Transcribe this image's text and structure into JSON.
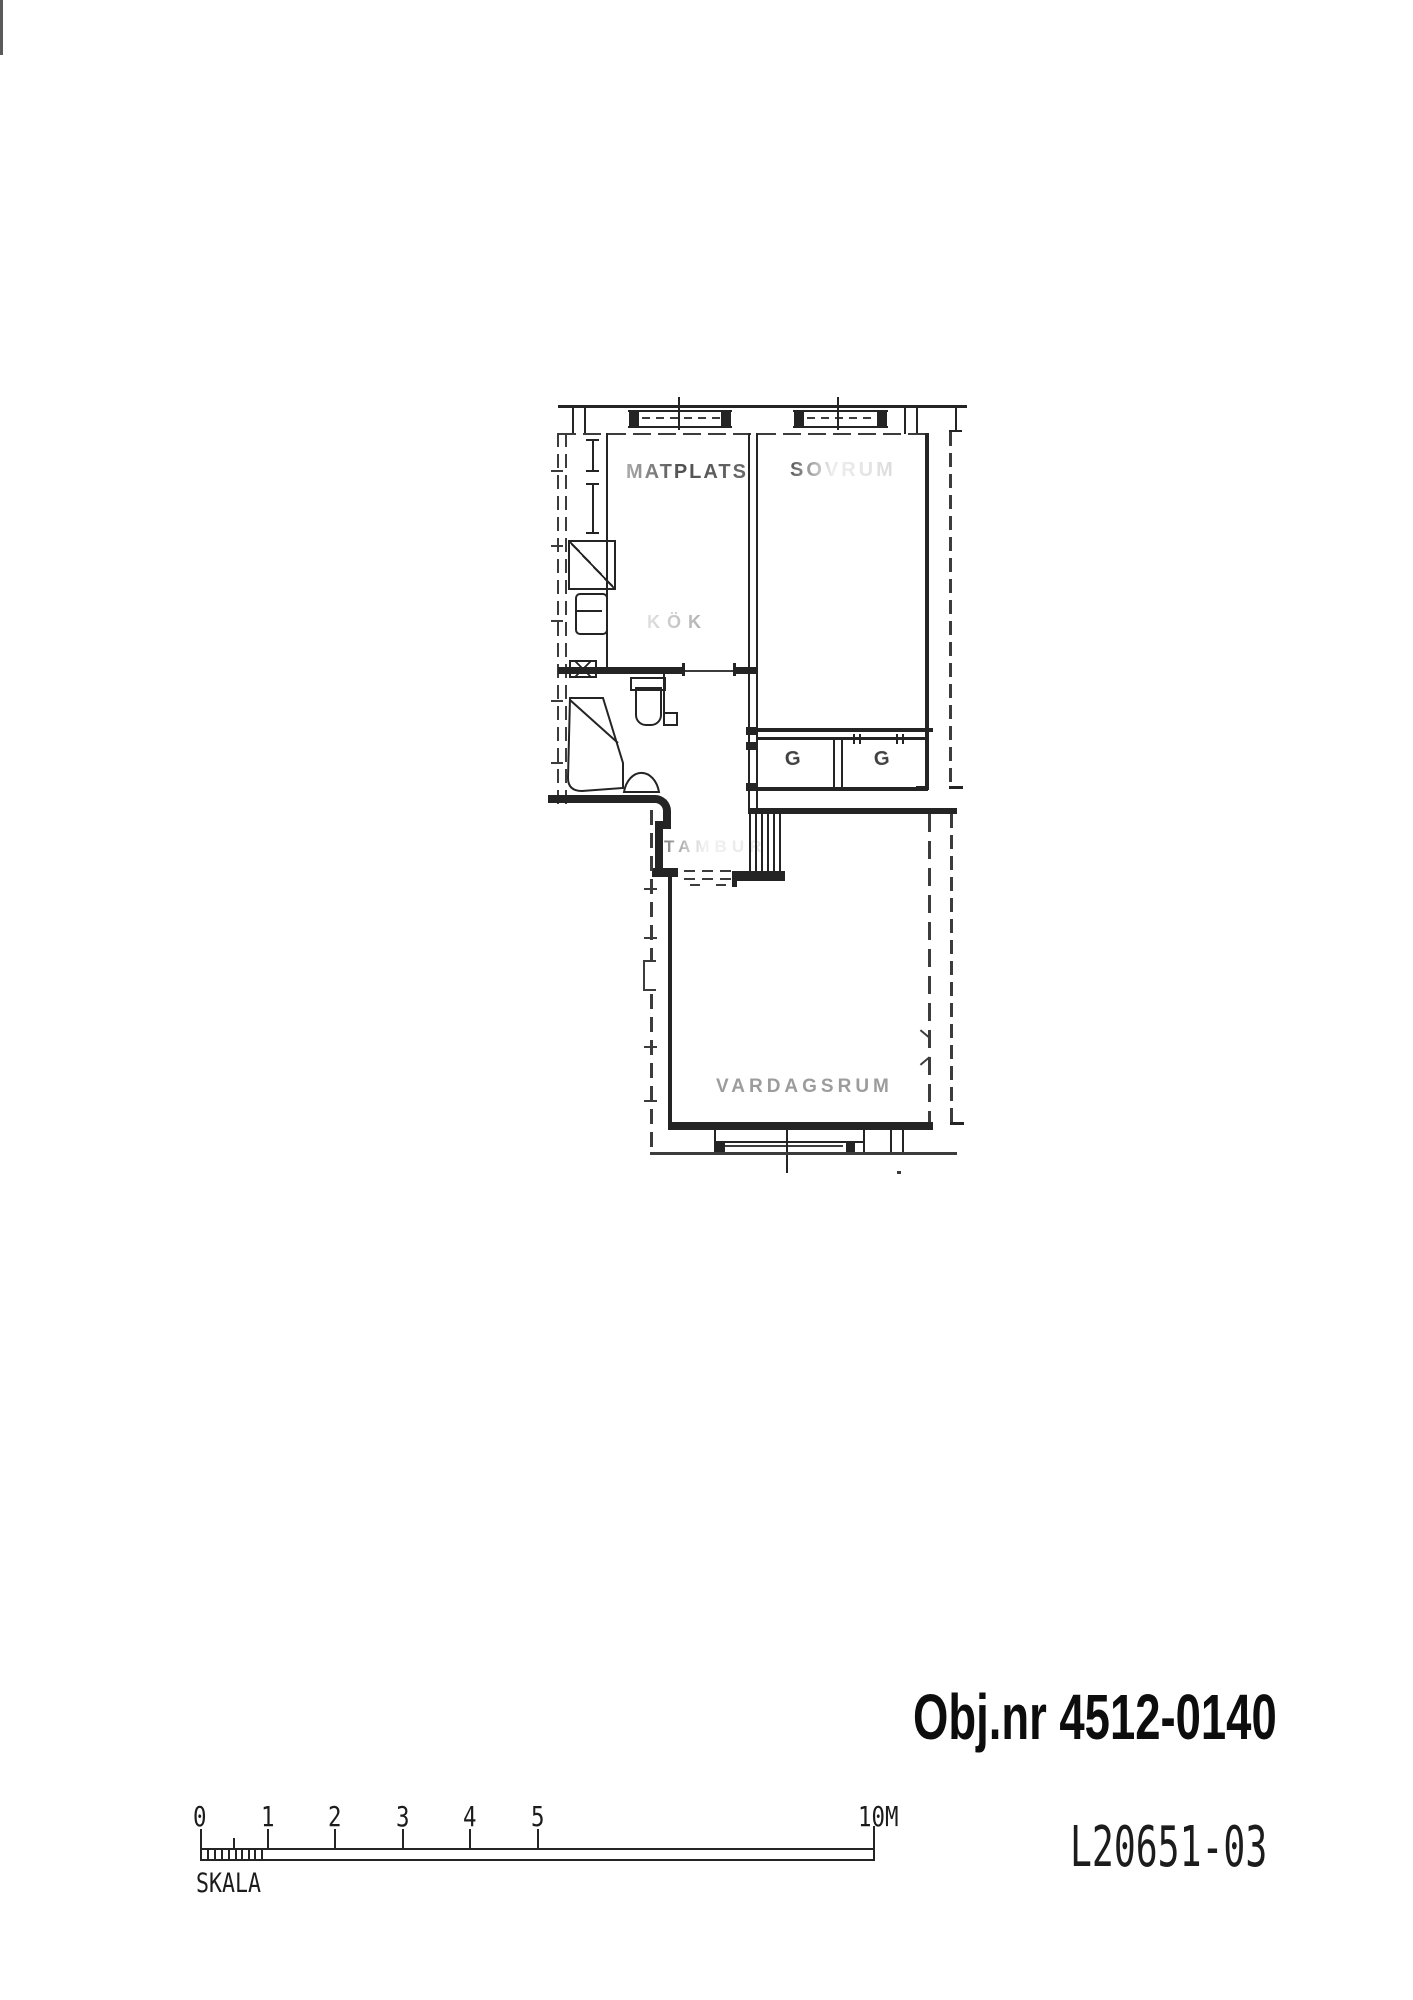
{
  "plan_labels": {
    "matplats": "MATPLATS",
    "sovrum": "SOVRUM",
    "kok": "KÖK",
    "tambur": "TAMBUR",
    "vardagsrum": "VARDAGSRUM",
    "closet_left": "G",
    "closet_right": "G"
  },
  "footer": {
    "object_number": "Obj.nr 4512-0140",
    "drawing_number": "L20651-03"
  },
  "scalebar": {
    "label": "SKALA",
    "numbers": [
      "0",
      "1",
      "2",
      "3",
      "4",
      "5"
    ],
    "end_label": "10M"
  }
}
